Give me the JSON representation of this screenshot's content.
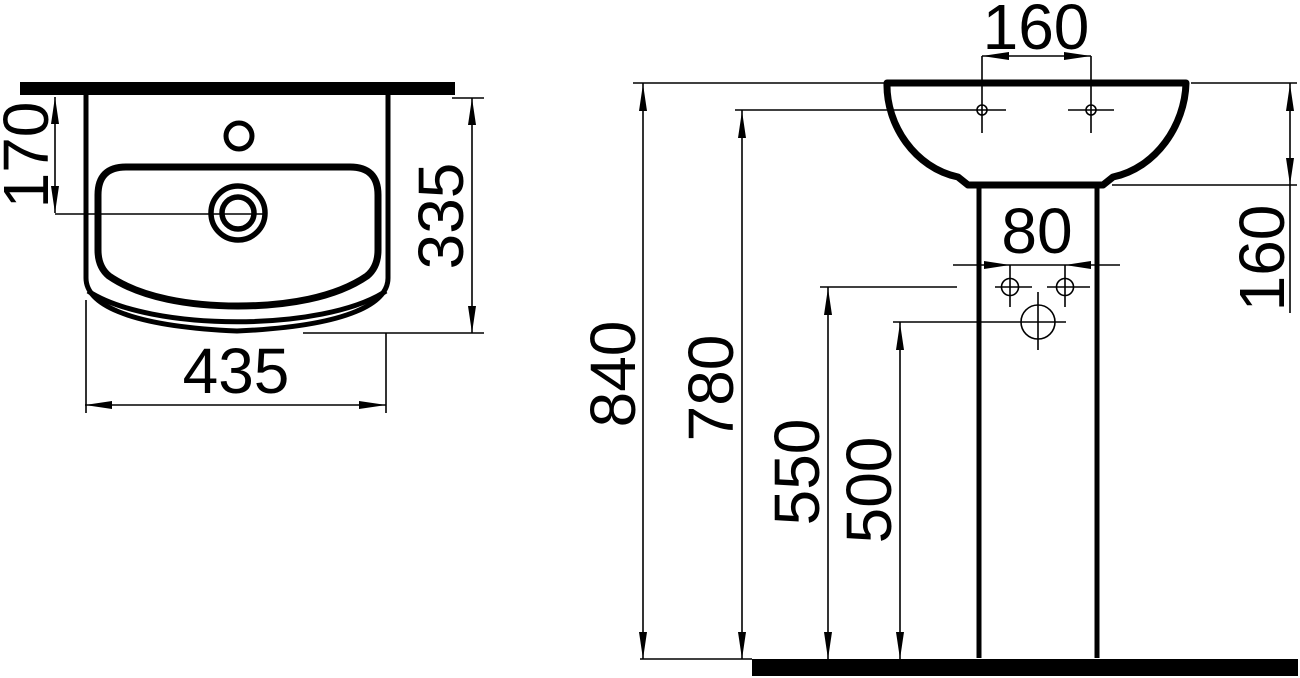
{
  "colors": {
    "ink": "#000000",
    "background": "#ffffff"
  },
  "plan_view": {
    "dim_wall_to_waste": "170",
    "dim_depth": "335",
    "dim_width": "435"
  },
  "front_view": {
    "dim_fixing_hole_spacing": "160",
    "dim_rim_to_pedestal_top": "160",
    "dim_pedestal_hole_spacing": "80",
    "dim_overall_height": "840",
    "dim_fixing_hole_height": "780",
    "dim_pedestal_hole_height": "550",
    "dim_siphon_height": "500"
  }
}
